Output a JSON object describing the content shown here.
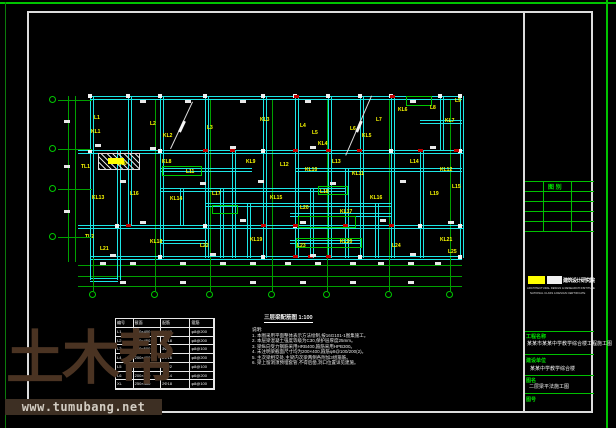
{
  "colors": {
    "beam_cyan": "#1ce6e6",
    "grid_green": "#00a000",
    "accent_green": "#00e400",
    "label_yellow": "#ffff00",
    "mark_red": "#c40000",
    "watermark_brown": "#4a3322",
    "watermark_band_bg": "#3d2f23"
  },
  "watermark": {
    "big_text": "土木帮",
    "site_text": "www.tumubang.net"
  },
  "notes": {
    "title": "三层梁配筋图 1:100",
    "label": "说明:",
    "items": [
      "1. 本图采用平面整体表示方法绘制,按16G101-1图集施工。",
      "2. 本层梁混凝土强度等级为C30,保护层厚度25mm。",
      "3. 梁纵向受力钢筋采用HRB400,箍筋采用HPB300。",
      "4. 未注明梁截面尺寸均为200×400,箍筋φ8@100/200(2)。",
      "5. 主次梁相交处,主梁内次梁两侧各附加3组箍筋。",
      "6. 梁上留洞须预埋套管,不得后凿,洞口位置详见建施。"
    ]
  },
  "schedule": {
    "headers": [
      "编号",
      "截面",
      "配筋",
      "箍筋"
    ],
    "rows": [
      [
        "L1",
        "200×400",
        "2Φ16",
        "φ8@200"
      ],
      [
        "L2",
        "200×450",
        "2Φ18",
        "φ8@200"
      ],
      [
        "L3",
        "250×500",
        "3Φ20",
        "φ8@100"
      ],
      [
        "L4",
        "200×400",
        "2Φ16",
        "φ8@200"
      ],
      [
        "L5",
        "250×550",
        "3Φ22",
        "φ8@100"
      ],
      [
        "L6",
        "200×300",
        "2Φ14",
        "φ6@200"
      ],
      [
        "XL",
        "250×400",
        "2Φ18",
        "φ8@100"
      ]
    ]
  },
  "titleblock": {
    "table_header": "图 别",
    "logo": {
      "cn": "建筑设计研究院",
      "en1": "ARCHITECTURAL DESIGN & RESEARCH INSTITUTE",
      "en2": "NATIONAL CLASS A DESIGN CERTIFICATE"
    },
    "fields": [
      {
        "label": "工程名称",
        "value": "某某市某某中学教学综合楼工程施工图"
      },
      {
        "label": "建设单位",
        "value": "某某中学教学综合楼"
      },
      {
        "label": "图名",
        "value": "二层梁平法施工图"
      },
      {
        "label": "图号",
        "value": ""
      }
    ],
    "lines_h": [
      [
        181,
        525,
        594
      ],
      [
        191,
        525,
        594
      ],
      [
        201,
        525,
        594
      ],
      [
        211,
        525,
        594
      ],
      [
        221,
        525,
        594
      ],
      [
        231,
        525,
        594
      ],
      [
        331,
        525,
        594
      ],
      [
        354,
        525,
        594
      ],
      [
        375,
        525,
        594
      ],
      [
        393,
        525,
        594
      ]
    ],
    "lines_v": [
      [
        543,
        181,
        231
      ],
      [
        571,
        181,
        231
      ]
    ]
  },
  "plan": {
    "hbeams": [
      [
        90,
        96,
        372
      ],
      [
        78,
        150,
        386
      ],
      [
        160,
        168,
        92
      ],
      [
        295,
        168,
        167
      ],
      [
        160,
        188,
        186
      ],
      [
        205,
        203,
        187
      ],
      [
        290,
        213,
        102
      ],
      [
        78,
        225,
        386
      ],
      [
        160,
        240,
        47
      ],
      [
        290,
        240,
        72
      ],
      [
        90,
        256,
        372
      ],
      [
        420,
        120,
        42
      ],
      [
        90,
        278,
        28
      ]
    ],
    "vbeams": [
      [
        90,
        96,
        258
      ],
      [
        117,
        150,
        258
      ],
      [
        128,
        96,
        225
      ],
      [
        160,
        96,
        258
      ],
      [
        205,
        96,
        258
      ],
      [
        232,
        150,
        258
      ],
      [
        263,
        96,
        258
      ],
      [
        295,
        96,
        258
      ],
      [
        328,
        96,
        258
      ],
      [
        360,
        96,
        258
      ],
      [
        391,
        96,
        258
      ],
      [
        420,
        150,
        258
      ],
      [
        440,
        96,
        150
      ],
      [
        460,
        96,
        258
      ],
      [
        345,
        168,
        258
      ],
      [
        310,
        188,
        258
      ],
      [
        180,
        188,
        225
      ],
      [
        220,
        188,
        258
      ],
      [
        247,
        203,
        258
      ],
      [
        375,
        203,
        258
      ],
      [
        90,
        258,
        280
      ],
      [
        117,
        258,
        280
      ]
    ],
    "grid_v": [
      [
        68,
        96,
        262
      ],
      [
        75,
        96,
        262
      ],
      [
        93,
        100,
        258
      ],
      [
        155,
        100,
        258
      ],
      [
        210,
        100,
        258
      ],
      [
        272,
        100,
        258
      ],
      [
        327,
        100,
        258
      ],
      [
        389,
        100,
        258
      ],
      [
        450,
        100,
        258
      ]
    ],
    "grid_h": [
      [
        265,
        78,
        462
      ],
      [
        276,
        78,
        462
      ],
      [
        286,
        78,
        462
      ]
    ],
    "hatch": [
      98,
      153,
      42,
      17
    ],
    "green_boxes": [
      [
        162,
        166,
        40,
        10
      ],
      [
        298,
        216,
        58,
        12
      ],
      [
        296,
        238,
        66,
        10
      ],
      [
        406,
        96,
        26,
        10
      ],
      [
        212,
        205,
        26,
        9
      ],
      [
        318,
        186,
        30,
        9
      ]
    ],
    "diagonals": [
      [
        193,
        102,
        171,
        149
      ],
      [
        372,
        96,
        346,
        156
      ]
    ],
    "white_joints": [
      [
        90,
        96
      ],
      [
        128,
        96
      ],
      [
        160,
        96
      ],
      [
        205,
        96
      ],
      [
        263,
        96
      ],
      [
        295,
        96
      ],
      [
        328,
        96
      ],
      [
        360,
        96
      ],
      [
        391,
        96
      ],
      [
        440,
        96
      ],
      [
        460,
        96
      ],
      [
        90,
        151
      ],
      [
        160,
        151
      ],
      [
        263,
        151
      ],
      [
        391,
        151
      ],
      [
        460,
        151
      ],
      [
        117,
        226
      ],
      [
        205,
        226
      ],
      [
        295,
        226
      ],
      [
        420,
        226
      ],
      [
        460,
        226
      ],
      [
        160,
        257
      ],
      [
        263,
        257
      ],
      [
        360,
        257
      ],
      [
        460,
        257
      ]
    ],
    "red_marks": [
      [
        203,
        149
      ],
      [
        230,
        149
      ],
      [
        293,
        149
      ],
      [
        326,
        149
      ],
      [
        357,
        149
      ],
      [
        418,
        149
      ],
      [
        454,
        149
      ],
      [
        126,
        224
      ],
      [
        261,
        224
      ],
      [
        293,
        224
      ],
      [
        343,
        224
      ],
      [
        389,
        224
      ],
      [
        293,
        255
      ],
      [
        308,
        255
      ],
      [
        326,
        255
      ],
      [
        294,
        95
      ],
      [
        390,
        95
      ]
    ],
    "white_ticks": [
      [
        140,
        100
      ],
      [
        185,
        100
      ],
      [
        240,
        100
      ],
      [
        305,
        100
      ],
      [
        410,
        100
      ],
      [
        95,
        144
      ],
      [
        150,
        147
      ],
      [
        230,
        146
      ],
      [
        310,
        146
      ],
      [
        430,
        146
      ],
      [
        120,
        180
      ],
      [
        200,
        182
      ],
      [
        258,
        180
      ],
      [
        330,
        182
      ],
      [
        400,
        180
      ],
      [
        140,
        221
      ],
      [
        240,
        219
      ],
      [
        300,
        221
      ],
      [
        380,
        219
      ],
      [
        448,
        221
      ],
      [
        110,
        254
      ],
      [
        210,
        253
      ],
      [
        310,
        254
      ],
      [
        410,
        253
      ],
      [
        100,
        262
      ],
      [
        130,
        262
      ],
      [
        180,
        262
      ],
      [
        220,
        262
      ],
      [
        250,
        262
      ],
      [
        285,
        262
      ],
      [
        315,
        262
      ],
      [
        350,
        262
      ],
      [
        378,
        262
      ],
      [
        408,
        262
      ],
      [
        435,
        262
      ],
      [
        120,
        281
      ],
      [
        180,
        281
      ],
      [
        250,
        281
      ],
      [
        300,
        281
      ],
      [
        350,
        281
      ],
      [
        408,
        281
      ],
      [
        64,
        120
      ],
      [
        64,
        165
      ],
      [
        64,
        210
      ]
    ],
    "yellow_rects": [
      [
        108,
        158,
        16,
        6
      ]
    ],
    "beam_labels": [
      [
        94,
        116,
        "L1"
      ],
      [
        91,
        130,
        "KL1"
      ],
      [
        150,
        122,
        "L2"
      ],
      [
        163,
        134,
        "KL2"
      ],
      [
        207,
        126,
        "L3"
      ],
      [
        260,
        118,
        "KL3"
      ],
      [
        300,
        124,
        "L4"
      ],
      [
        312,
        131,
        "L5"
      ],
      [
        318,
        142,
        "KL4"
      ],
      [
        350,
        127,
        "L6"
      ],
      [
        362,
        134,
        "KL5"
      ],
      [
        376,
        118,
        "L7"
      ],
      [
        398,
        108,
        "KL6"
      ],
      [
        430,
        106,
        "L8"
      ],
      [
        445,
        119,
        "KL7"
      ],
      [
        455,
        99,
        "L9"
      ],
      [
        81,
        165,
        "TL1"
      ],
      [
        118,
        162,
        "L10"
      ],
      [
        162,
        160,
        "KL8"
      ],
      [
        186,
        170,
        "L11"
      ],
      [
        246,
        160,
        "KL9"
      ],
      [
        280,
        163,
        "L12"
      ],
      [
        305,
        168,
        "KL10"
      ],
      [
        332,
        160,
        "L13"
      ],
      [
        352,
        172,
        "KL11"
      ],
      [
        410,
        160,
        "L14"
      ],
      [
        440,
        168,
        "KL12"
      ],
      [
        452,
        185,
        "L15"
      ],
      [
        92,
        196,
        "KL13"
      ],
      [
        130,
        192,
        "L16"
      ],
      [
        170,
        197,
        "KL14"
      ],
      [
        212,
        192,
        "L17"
      ],
      [
        270,
        196,
        "KL15"
      ],
      [
        320,
        190,
        "L18"
      ],
      [
        370,
        196,
        "KL16"
      ],
      [
        430,
        192,
        "L19"
      ],
      [
        300,
        206,
        "L20"
      ],
      [
        340,
        210,
        "KL17"
      ],
      [
        85,
        235,
        "TL2"
      ],
      [
        100,
        247,
        "L21"
      ],
      [
        150,
        240,
        "KL18"
      ],
      [
        200,
        244,
        "L22"
      ],
      [
        250,
        238,
        "KL19"
      ],
      [
        297,
        244,
        "L23"
      ],
      [
        340,
        240,
        "KL20"
      ],
      [
        392,
        244,
        "L24"
      ],
      [
        440,
        238,
        "KL21"
      ],
      [
        448,
        250,
        "L25"
      ]
    ],
    "bubbles_bottom": [
      93,
      155,
      210,
      272,
      327,
      389,
      450
    ],
    "bubbles_left": [
      100,
      149,
      189,
      237
    ]
  }
}
